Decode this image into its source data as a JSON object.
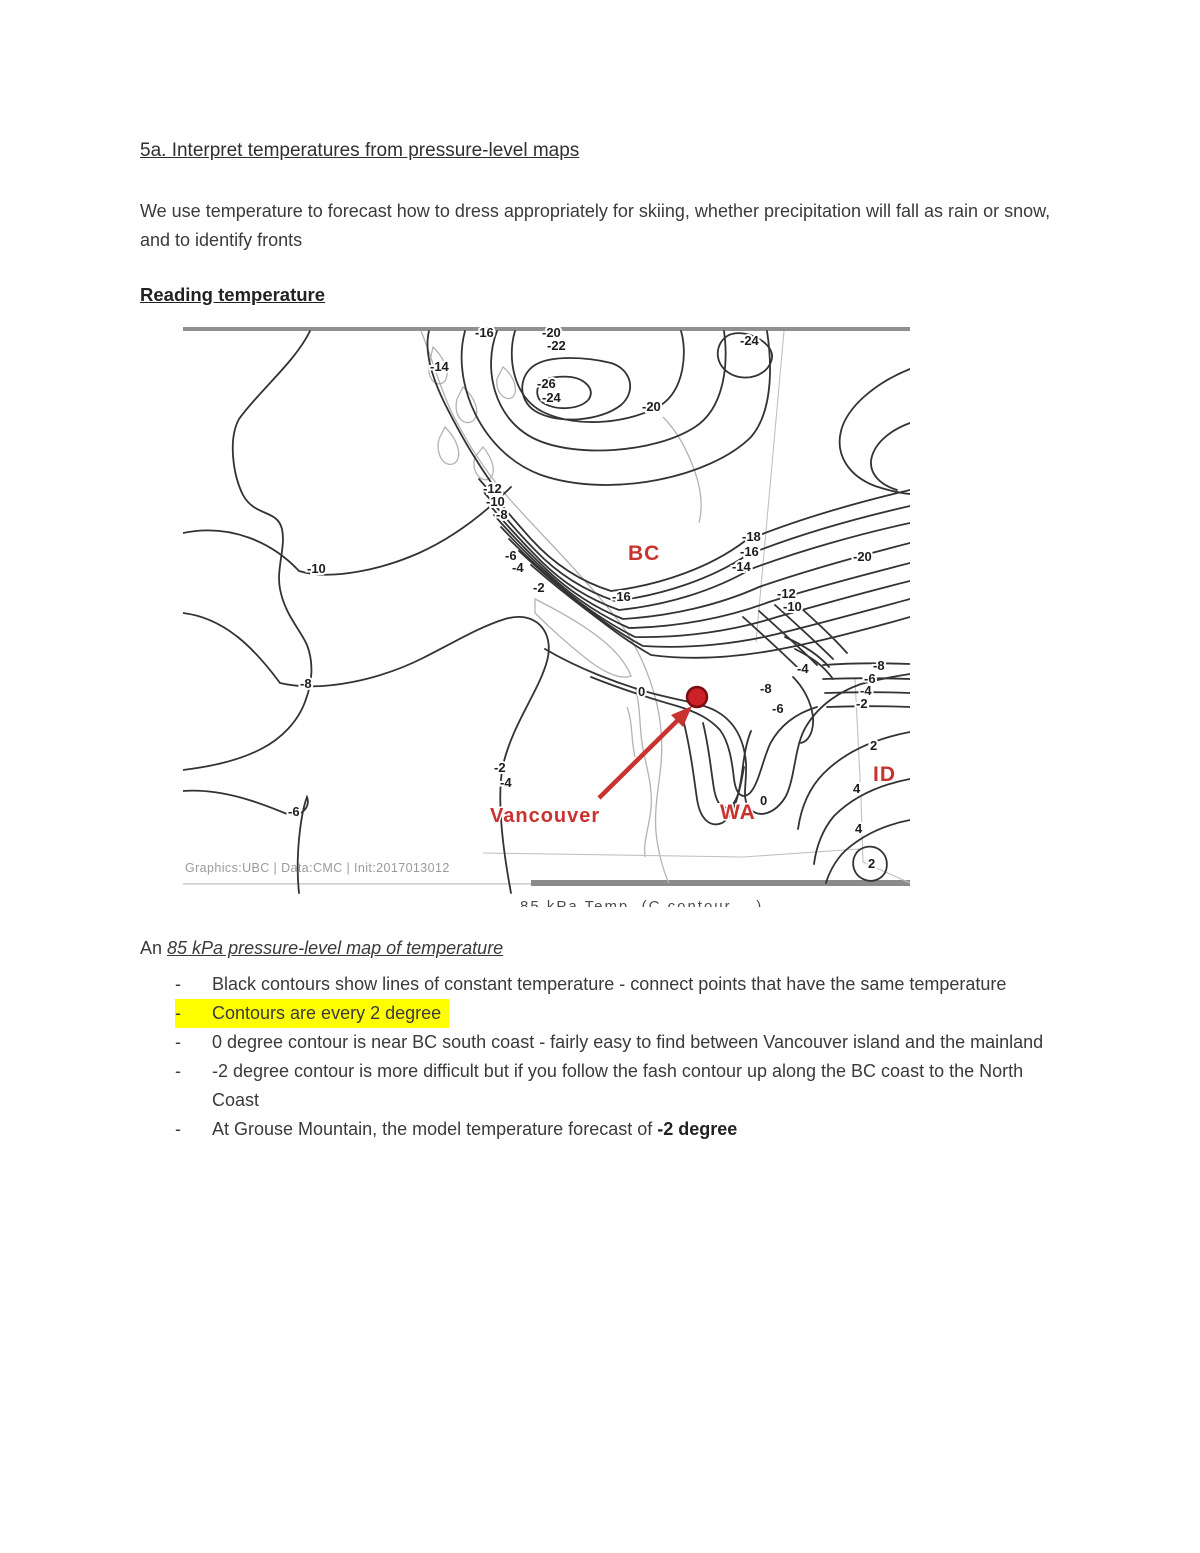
{
  "page": {
    "title": "5a. Interpret temperatures from pressure-level maps",
    "intro": "We use temperature to forecast how to dress appropriately for skiing, whether precipitation will fall as rain or snow, and to identify fronts",
    "section_heading": "Reading temperature"
  },
  "map": {
    "attribution": "Graphics:UBC  |  Data:CMC  |  Init:2017013012",
    "caption_cropped": "85 kPa Temp.   (C contour ...)",
    "accent_red": "#c8332f",
    "marker": {
      "x": 514,
      "y": 370,
      "r": 10
    },
    "arrow": {
      "x1": 416,
      "y1": 471,
      "x2": 497,
      "y2": 391
    },
    "region_labels": [
      {
        "text": "BC",
        "x": 445,
        "y": 233,
        "size": 21
      },
      {
        "text": "WA",
        "x": 537,
        "y": 492,
        "size": 21
      },
      {
        "text": "ID",
        "x": 690,
        "y": 454,
        "size": 21
      },
      {
        "text": "Vancouver",
        "x": 307,
        "y": 495,
        "size": 20
      }
    ],
    "contour_labels": [
      {
        "t": "-16",
        "x": 292,
        "y": 10
      },
      {
        "t": "-20",
        "x": 359,
        "y": 10
      },
      {
        "t": "-22",
        "x": 364,
        "y": 23
      },
      {
        "t": "-24",
        "x": 557,
        "y": 18
      },
      {
        "t": "-14",
        "x": 247,
        "y": 44
      },
      {
        "t": "-26",
        "x": 354,
        "y": 61
      },
      {
        "t": "-24",
        "x": 359,
        "y": 75
      },
      {
        "t": "-20",
        "x": 459,
        "y": 84
      },
      {
        "t": "-12",
        "x": 300,
        "y": 166
      },
      {
        "t": "-10",
        "x": 303,
        "y": 179
      },
      {
        "t": "-8",
        "x": 313,
        "y": 192
      },
      {
        "t": "-18",
        "x": 559,
        "y": 214
      },
      {
        "t": "-16",
        "x": 557,
        "y": 229
      },
      {
        "t": "-14",
        "x": 549,
        "y": 244
      },
      {
        "t": "-20",
        "x": 670,
        "y": 234
      },
      {
        "t": "-6",
        "x": 322,
        "y": 233
      },
      {
        "t": "-4",
        "x": 329,
        "y": 245
      },
      {
        "t": "-10",
        "x": 124,
        "y": 246
      },
      {
        "t": "-2",
        "x": 350,
        "y": 265
      },
      {
        "t": "-12",
        "x": 594,
        "y": 271
      },
      {
        "t": "-16",
        "x": 429,
        "y": 274
      },
      {
        "t": "-10",
        "x": 600,
        "y": 284
      },
      {
        "t": "-8",
        "x": 690,
        "y": 343
      },
      {
        "t": "-4",
        "x": 614,
        "y": 346
      },
      {
        "t": "-6",
        "x": 681,
        "y": 356
      },
      {
        "t": "-8",
        "x": 117,
        "y": 361
      },
      {
        "t": "-8",
        "x": 577,
        "y": 366
      },
      {
        "t": "0",
        "x": 455,
        "y": 369
      },
      {
        "t": "-4",
        "x": 677,
        "y": 368
      },
      {
        "t": "-2",
        "x": 673,
        "y": 381
      },
      {
        "t": "-6",
        "x": 589,
        "y": 386
      },
      {
        "t": "2",
        "x": 687,
        "y": 423
      },
      {
        "t": "-2",
        "x": 311,
        "y": 445
      },
      {
        "t": "-4",
        "x": 317,
        "y": 460
      },
      {
        "t": "4",
        "x": 670,
        "y": 466
      },
      {
        "t": "0",
        "x": 577,
        "y": 478
      },
      {
        "t": "-6",
        "x": 105,
        "y": 489
      },
      {
        "t": "4",
        "x": 672,
        "y": 506
      },
      {
        "t": "2",
        "x": 685,
        "y": 541
      }
    ]
  },
  "notes": {
    "lead_plain": "An ",
    "lead_italic": "85 kPa pressure-level map of temperature",
    "bullets": [
      {
        "text": "Black contours show lines of constant temperature - connect points that have the same temperature",
        "highlight": false
      },
      {
        "text": "Contours are every 2 degree",
        "highlight": true
      },
      {
        "text": "0 degree contour is near BC south coast - fairly easy to find between Vancouver island and the mainland",
        "highlight": false
      },
      {
        "text": "-2 degree contour is more difficult but if you follow the fash contour up along the BC coast to the North Coast",
        "highlight": false
      },
      {
        "text": "At Grouse Mountain, the model temperature forecast of ",
        "bold_suffix": "-2 degree",
        "highlight": false
      }
    ]
  }
}
